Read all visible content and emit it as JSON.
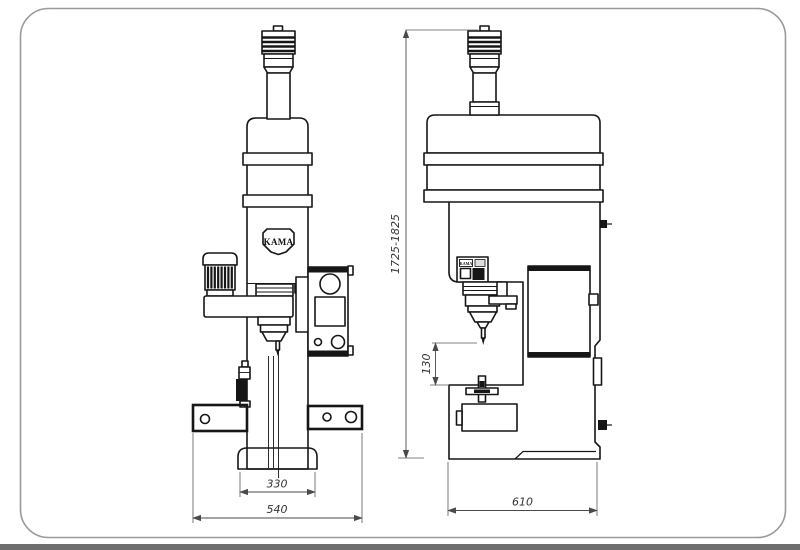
{
  "page": {
    "background": "#ffffff",
    "frame_color": "#9a9a9a",
    "line_color": "#161616",
    "footer_bar_color": "#6e6e6e"
  },
  "drawing": {
    "brand_badge": "KAMA",
    "control_box_label": "KAMA",
    "dimensions": {
      "front_base_width": "330",
      "front_overall_width": "540",
      "side_overall_depth": "610",
      "side_throat_height": "130",
      "overall_height_range": "1725-1825"
    }
  }
}
